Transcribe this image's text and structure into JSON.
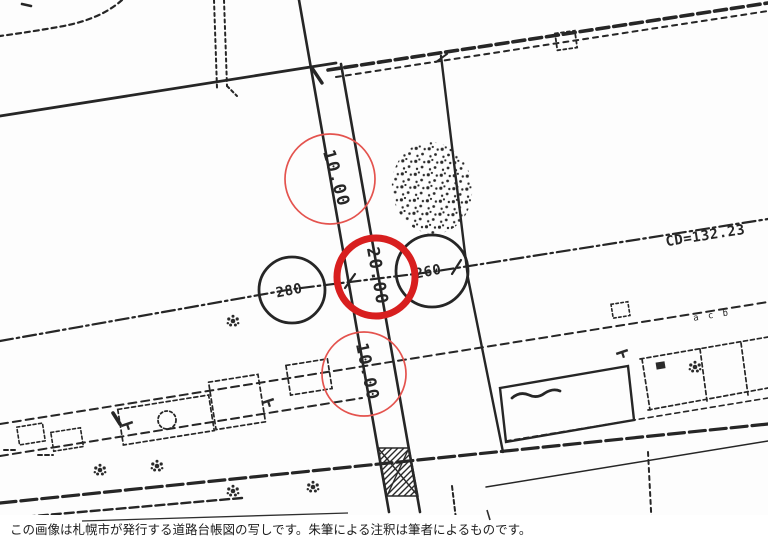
{
  "colors": {
    "paper": "#fdfdfd",
    "ink": "#262626",
    "red_bold": "#d81f1f",
    "red_light": "#e4534e"
  },
  "map": {
    "kind": "scanned road ledger drawing",
    "stations": {
      "left": "280",
      "right": "260"
    },
    "cd_label": "CD=132.23",
    "width_annotations": {
      "upper": {
        "value": "10.00",
        "circle": "thin-red-circle"
      },
      "center": {
        "value": "20.00",
        "circle": "bold-red-circle"
      },
      "lower": {
        "value": "10.00",
        "circle": "thin-red-circle"
      }
    },
    "tiny_marks": "a c b"
  },
  "caption": {
    "text": "この画像は札幌市が発行する道路台帳図の写しです。朱筆による注釈は筆者によるものです。"
  }
}
